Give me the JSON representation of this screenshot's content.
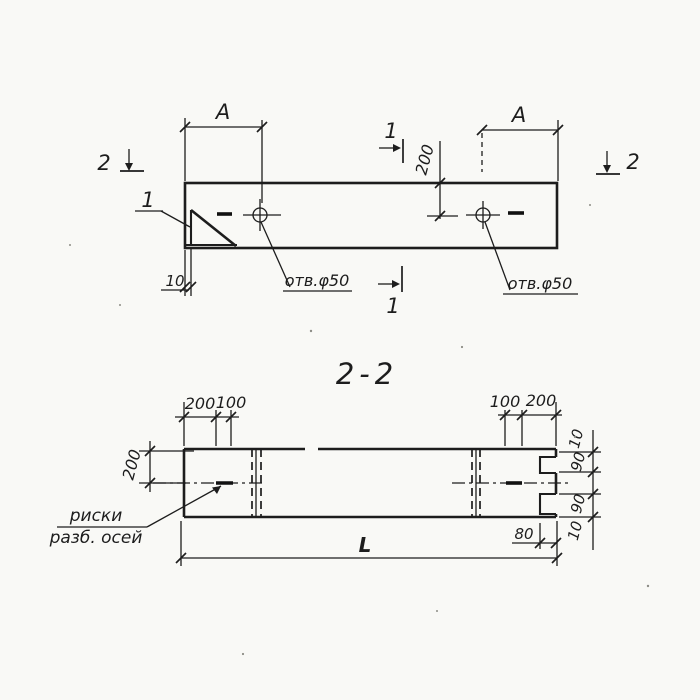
{
  "meta": {
    "ink": "#1d1d1d",
    "paper": "#f9f9f6"
  },
  "top_view": {
    "dim_a_left": "A",
    "dim_a_right": "A",
    "dim_depth": "200",
    "dim_edge_offset": "10",
    "detail_mark": "1",
    "hole_note_left": "отв.φ50",
    "hole_note_right": "отв.φ50",
    "cut_1_top": "1",
    "cut_1_bottom": "1",
    "cut_2_left": "2",
    "cut_2_right": "2"
  },
  "section_view": {
    "title": "2-2",
    "dim_top_left_200": "200",
    "dim_top_left_100": "100",
    "dim_top_right_100": "100",
    "dim_top_right_200": "200",
    "dim_height": "200",
    "dim_right_10_top": "10",
    "dim_right_90_top": "90",
    "dim_right_90_bottom": "90",
    "dim_right_10_bottom": "10",
    "dim_groove": "80",
    "dim_length": "L",
    "axes_note_line1": "риски",
    "axes_note_line2": "разб. осей"
  }
}
